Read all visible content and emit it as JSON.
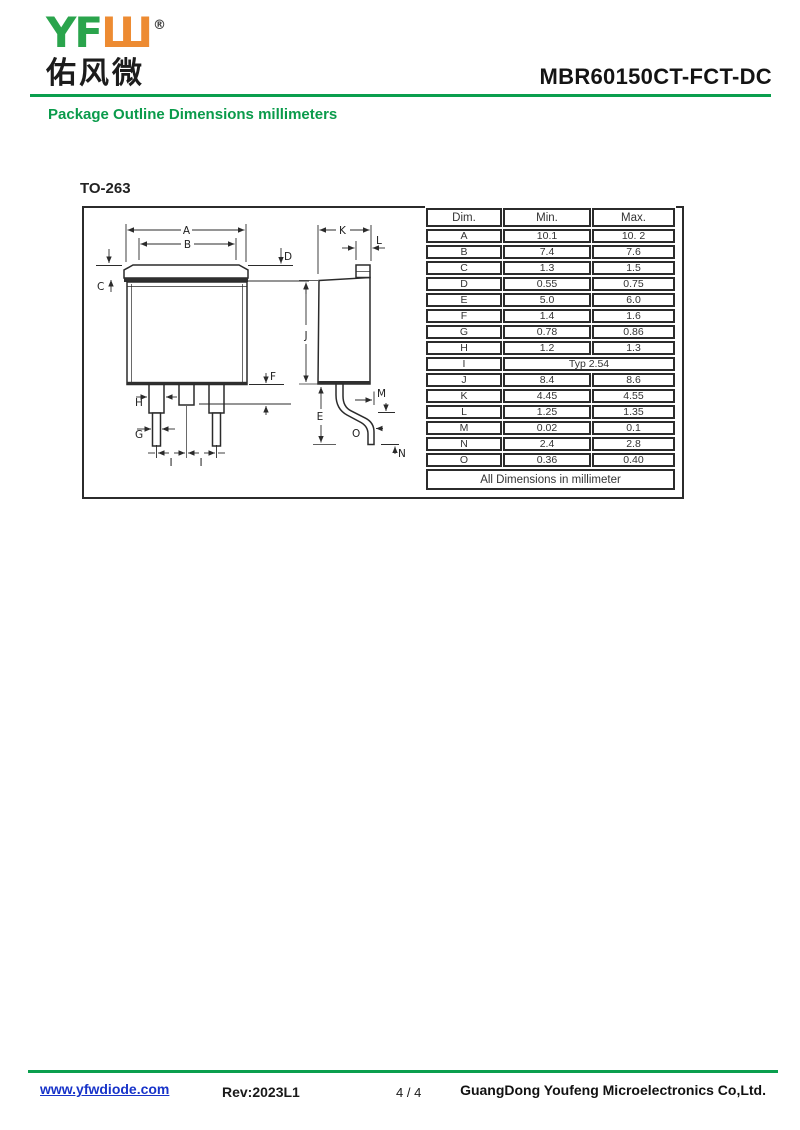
{
  "header": {
    "logo_green": "YF",
    "logo_orange": "Ш",
    "registered_mark": "®",
    "logo_chinese": "佑风微",
    "part_number": "MBR60150CT-FCT-DC",
    "section_title": "Package Outline Dimensions millimeters"
  },
  "drawing": {
    "package_name": "TO-263",
    "labels": {
      "A": "A",
      "B": "B",
      "C": "C",
      "D": "D",
      "E": "E",
      "F": "F",
      "G": "G",
      "H": "H",
      "I": "I",
      "J": "J",
      "K": "K",
      "L": "L",
      "M": "M",
      "N": "N",
      "O": "O"
    }
  },
  "table": {
    "headers": [
      "Dim.",
      "Min.",
      "Max."
    ],
    "rows": [
      {
        "dim": "A",
        "min": "10.1",
        "max": "10. 2"
      },
      {
        "dim": "B",
        "min": "7.4",
        "max": "7.6"
      },
      {
        "dim": "C",
        "min": "1.3",
        "max": "1.5"
      },
      {
        "dim": "D",
        "min": "0.55",
        "max": "0.75"
      },
      {
        "dim": "E",
        "min": "5.0",
        "max": "6.0"
      },
      {
        "dim": "F",
        "min": "1.4",
        "max": "1.6"
      },
      {
        "dim": "G",
        "min": "0.78",
        "max": "0.86"
      },
      {
        "dim": "H",
        "min": "1.2",
        "max": "1.3"
      },
      {
        "dim": "I",
        "typ": "Typ 2.54"
      },
      {
        "dim": "J",
        "min": "8.4",
        "max": "8.6"
      },
      {
        "dim": "K",
        "min": "4.45",
        "max": "4.55"
      },
      {
        "dim": "L",
        "min": "1.25",
        "max": "1.35"
      },
      {
        "dim": "M",
        "min": "0.02",
        "max": "0.1"
      },
      {
        "dim": "N",
        "min": "2.4",
        "max": "2.8"
      },
      {
        "dim": "O",
        "min": "0.36",
        "max": "0.40"
      }
    ],
    "note": "All Dimensions in millimeter"
  },
  "footer": {
    "website": "www.yfwdiode.com",
    "revision": "Rev:2023L1",
    "page": "4 / 4",
    "company": "GuangDong Youfeng Microelectronics Co,Ltd."
  },
  "colors": {
    "brand_green": "#2aa44c",
    "brand_orange": "#ed8b32",
    "heading_green": "#0a9b4b",
    "link_blue": "#1733c9"
  }
}
